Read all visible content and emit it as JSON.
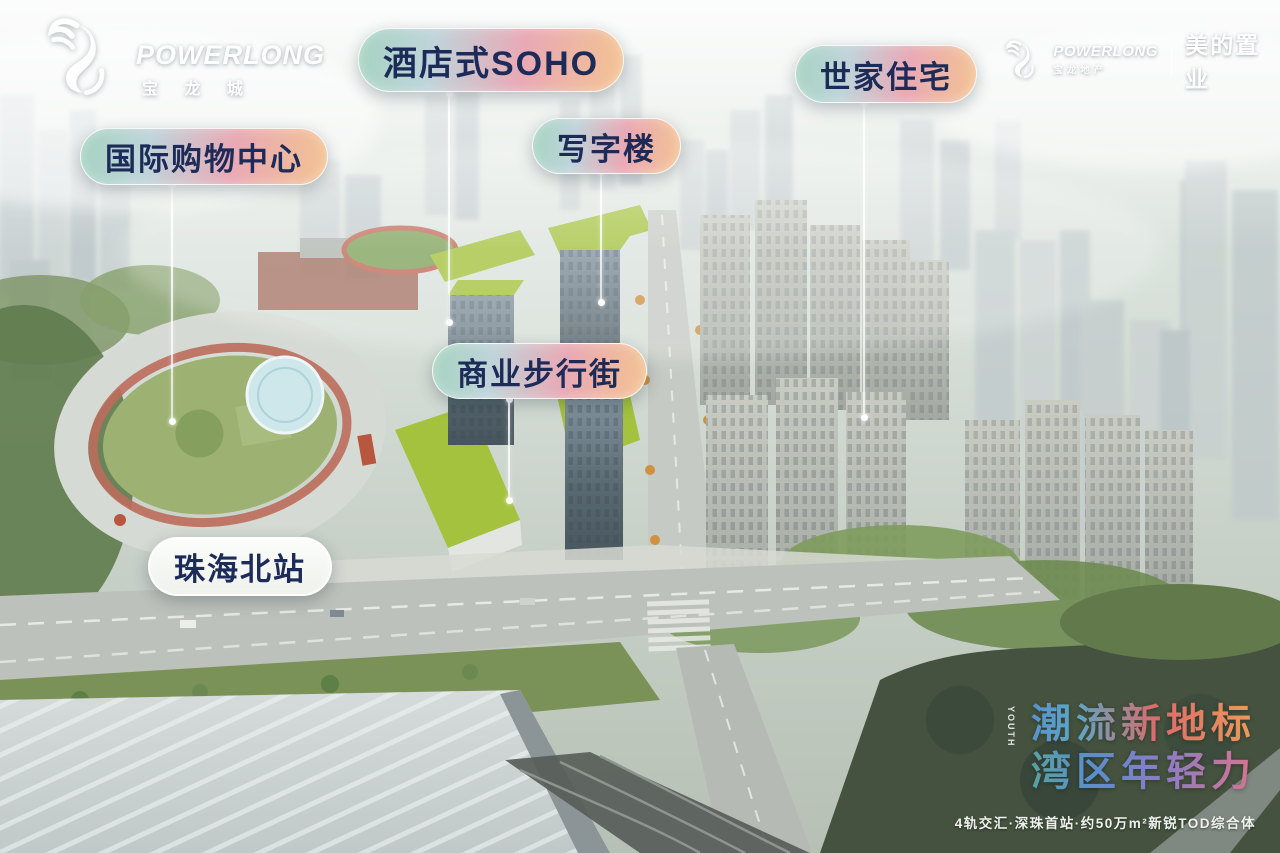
{
  "brand_top_left": {
    "logotype": "POWERLONG",
    "wordmark": "宝 龙 城"
  },
  "brand_top_right": {
    "logotype": "POWERLONG",
    "sub_wordmark": "宝龙地产",
    "partner_wordmark": "美的置业"
  },
  "callouts": [
    {
      "id": "hotel-style-soho",
      "text": "酒店式SOHO"
    },
    {
      "id": "international-shopping-mall",
      "text": "国际购物中心"
    },
    {
      "id": "office-tower",
      "text": "写字楼"
    },
    {
      "id": "heritage-residences",
      "text": "世家住宅"
    },
    {
      "id": "commercial-pedestrian-street",
      "text": "商业步行街"
    },
    {
      "id": "zhuhai-north-station",
      "text": "珠海北站"
    }
  ],
  "slogan": {
    "vertical_text": "YOUTH",
    "line1": "潮流新地标",
    "line2": "湾区年轻力",
    "subline": "4轨交汇·深珠首站·约50万m²新锐TOD综合体"
  },
  "colors": {
    "pill_gradient": [
      "#a5d3c0",
      "#bfd4da",
      "#e9a9b5",
      "#f3c392"
    ],
    "pill_text": "#1c2b57",
    "station_pill_background": "#f6f8f4",
    "leader_line": "#ffffff",
    "slogan_line1_gradient": [
      "#6fa45a",
      "#5a8ecd",
      "#df6a6b",
      "#eb9c5a"
    ],
    "slogan_line2_gradient": [
      "#78ab5e",
      "#58a795",
      "#5a8ecd",
      "#8d7cc5",
      "#d9738f"
    ]
  },
  "icons": [
    {
      "name": "dragon-icon"
    }
  ]
}
